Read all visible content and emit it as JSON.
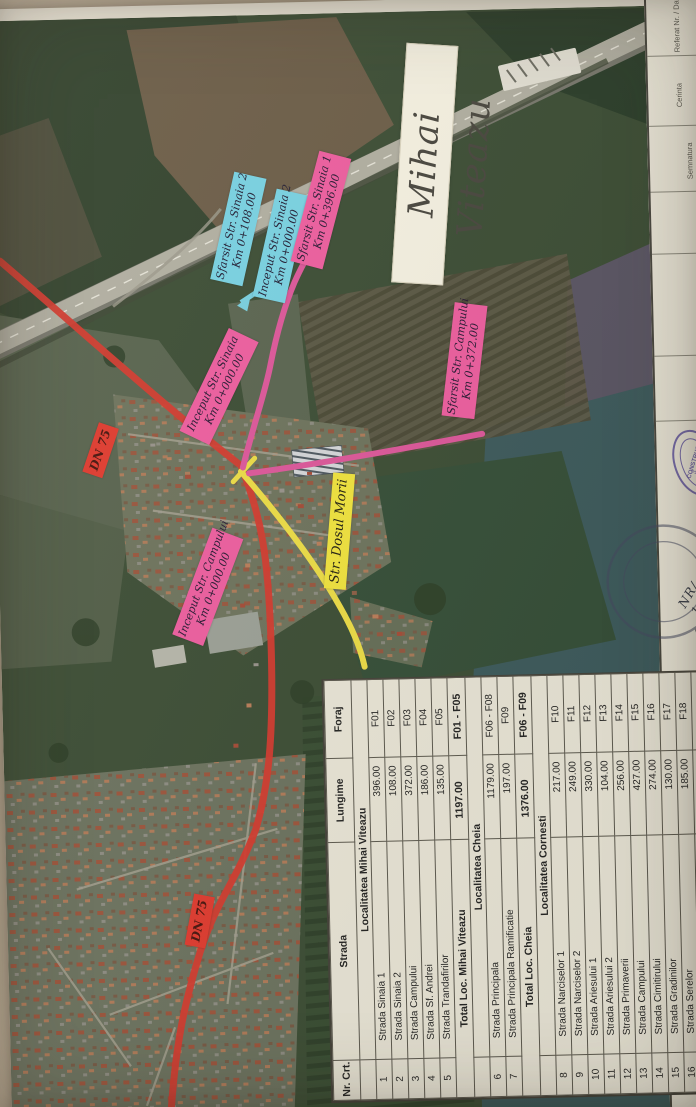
{
  "paper": {
    "map_title": "Mihai Viteazu"
  },
  "labels": [
    {
      "id": "sfarsit-sinaia-2",
      "line1": "Sfarsit Str. Sinaia 2",
      "line2": "Km 0+108.00",
      "style": "cyan"
    },
    {
      "id": "inceput-sinaia-2",
      "line1": "Inceput Str. Sinaia 2",
      "line2": "Km 0+000.00",
      "style": "cyan"
    },
    {
      "id": "sfarsit-sinaia-1",
      "line1": "Sfarsit Str. Sinaia 1",
      "line2": "Km 0+396.00",
      "style": "pink"
    },
    {
      "id": "sfarsit-campului",
      "line1": "Sfarsit Str. Campului",
      "line2": "Km 0+372.00",
      "style": "pink"
    },
    {
      "id": "inceput-sinaia",
      "line1": "Inceput Str. Sinaia",
      "line2": "Km 0+000.00",
      "style": "pink"
    },
    {
      "id": "dn75-north",
      "line1": "DN 75",
      "line2": "",
      "style": "red"
    },
    {
      "id": "dosul-morii",
      "line1": "Str. Dosul Morii",
      "line2": "",
      "style": "yellow"
    },
    {
      "id": "inceput-campului",
      "line1": "Inceput Str. Campului",
      "line2": "Km 0+000.00",
      "style": "pink"
    },
    {
      "id": "dn75-south",
      "line1": "DN 75",
      "line2": "",
      "style": "red"
    }
  ],
  "table": {
    "headers": [
      "Nr. Crt.",
      "Strada",
      "Lungime",
      "Foraj"
    ],
    "sections": [
      {
        "title": "Localitatea Mihai Viteazu",
        "rows": [
          [
            "1",
            "Strada Sinaia 1",
            "396.00",
            "F01"
          ],
          [
            "2",
            "Strada Sinaia 2",
            "108.00",
            "F02"
          ],
          [
            "3",
            "Strada Campului",
            "372.00",
            "F03"
          ],
          [
            "4",
            "Strada Sf. Andrei",
            "186.00",
            "F04"
          ],
          [
            "5",
            "Strada Trandafirilor",
            "135.00",
            "F05"
          ]
        ],
        "total": [
          "Total Loc. Mihai Viteazu",
          "1197.00",
          "F01 - F05"
        ]
      },
      {
        "title": "Localitatea Cheia",
        "rows": [
          [
            "6",
            "Strada Principala",
            "1179.00",
            "F06 - F08"
          ],
          [
            "7",
            "Strada Principala Ramificatie",
            "197.00",
            "F09"
          ]
        ],
        "total": [
          "Total Loc. Cheia",
          "1376.00",
          "F06 - F09"
        ]
      },
      {
        "title": "Localitatea Cornesti",
        "rows": [
          [
            "8",
            "Strada Narciselor 1",
            "217.00",
            "F10"
          ],
          [
            "9",
            "Strada Narciselor 2",
            "249.00",
            "F11"
          ],
          [
            "10",
            "Strada Ariesului 1",
            "330.00",
            "F12"
          ],
          [
            "11",
            "Strada Ariesului 2",
            "104.00",
            "F13"
          ],
          [
            "12",
            "Strada Primaverii",
            "256.00",
            "F14"
          ],
          [
            "13",
            "Strada Campului",
            "427.00",
            "F15"
          ],
          [
            "14",
            "Strada Cimitirului",
            "274.00",
            "F16"
          ],
          [
            "15",
            "Strada Gradinilor",
            "130.00",
            "F17"
          ],
          [
            "16",
            "Strada Serelor",
            "185.00",
            "F18"
          ]
        ],
        "total": [
          "Total Loc. Cornesti",
          "2172.00",
          "F10 - F18"
        ]
      }
    ],
    "grand_total": [
      "Total proiect",
      "4745.00",
      "F01 - F18"
    ]
  },
  "title_block": {
    "fields": [
      "Referat Nr. / Data",
      "Cerinta",
      "Semnatura",
      "Nume",
      "Verificator"
    ],
    "stamp_word": "CONSTRUCT",
    "stamp_number": "3",
    "handwritten": "NR/ 11347",
    "note": "ING",
    "edge_text": "MIHAI VITEAZU"
  },
  "colors": {
    "route_red": "#e03126",
    "route_yellow": "#f2e135",
    "route_pink": "#e9509e",
    "route_cyan": "#6fd3e6",
    "label_pink": "#ee5b9f",
    "label_cyan": "#76d2e4",
    "label_yellow": "#f1e43b",
    "label_red": "#e0372c"
  }
}
